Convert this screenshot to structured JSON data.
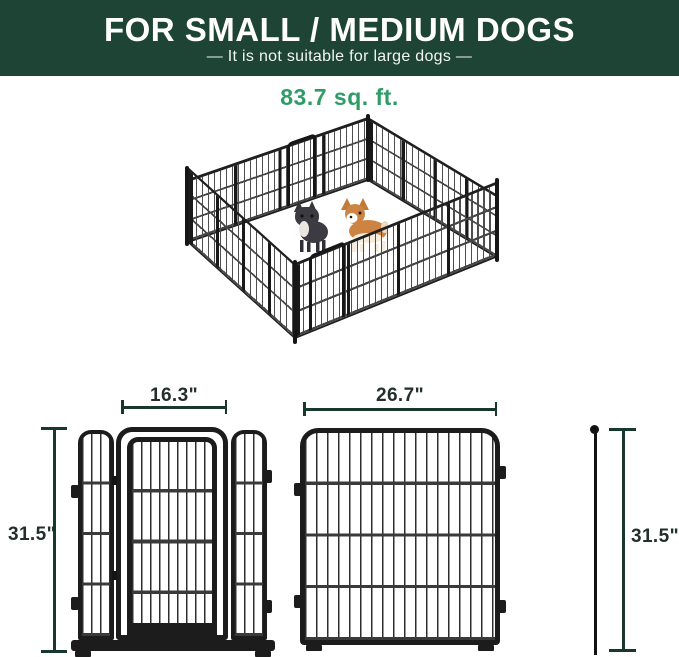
{
  "header": {
    "title": "FOR SMALL / MEDIUM DOGS",
    "subtitle": "—  It is not suitable for large dogs  —"
  },
  "illustration": {
    "area_label": "83.7 sq. ft.",
    "dogs": [
      "french-bulldog-icon",
      "corgi-icon"
    ],
    "enclosure": "16-panel wire playpen, isometric view"
  },
  "diagrams": {
    "door_panel": {
      "width_label": "16.3\"",
      "height_label": "31.5\""
    },
    "regular_panel": {
      "width_label": "26.7\"",
      "height_label": "31.5\""
    }
  },
  "colors": {
    "header_bg": "#1d4434",
    "header_text": "#ffffff",
    "accent_green": "#2f9c68",
    "dimension_line": "#17382b",
    "dimension_text": "#233029",
    "fence_black": "#1c1c1c"
  }
}
